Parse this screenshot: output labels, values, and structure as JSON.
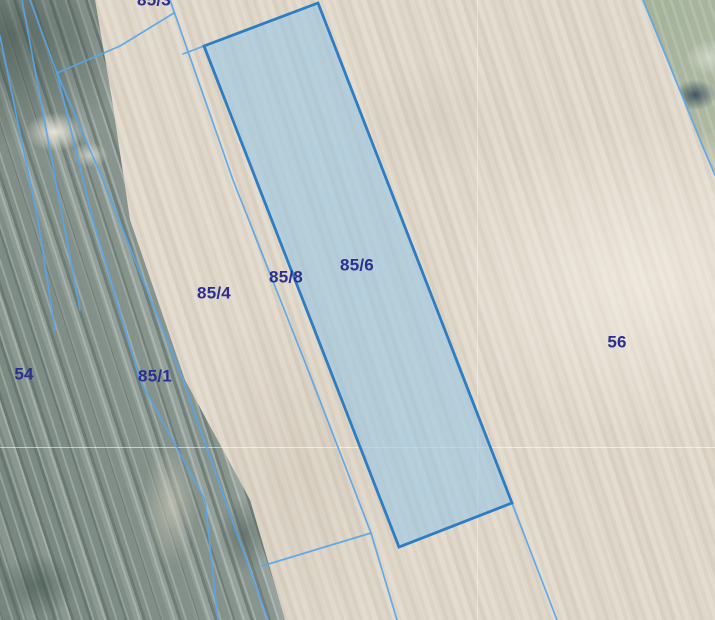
{
  "map": {
    "selected_parcel_id": "85/6",
    "labels": [
      {
        "id": "85-3",
        "text": "85/3",
        "x": 154,
        "y": 0
      },
      {
        "id": "85-4",
        "text": "85/4",
        "x": 214,
        "y": 293
      },
      {
        "id": "85-8",
        "text": "85/8",
        "x": 286,
        "y": 277
      },
      {
        "id": "85-6",
        "text": "85/6",
        "x": 357,
        "y": 265
      },
      {
        "id": "85-1",
        "text": "85/1",
        "x": 155,
        "y": 376
      },
      {
        "id": "54",
        "text": "54",
        "x": 24,
        "y": 374
      },
      {
        "id": "56",
        "text": "56",
        "x": 617,
        "y": 342
      }
    ],
    "colors": {
      "boundary_line": "#57a5ea",
      "selected_parcel_fill": "#92c4e5",
      "selected_parcel_stroke": "#2e7dc2",
      "label_text": "#2b2f8f"
    }
  }
}
